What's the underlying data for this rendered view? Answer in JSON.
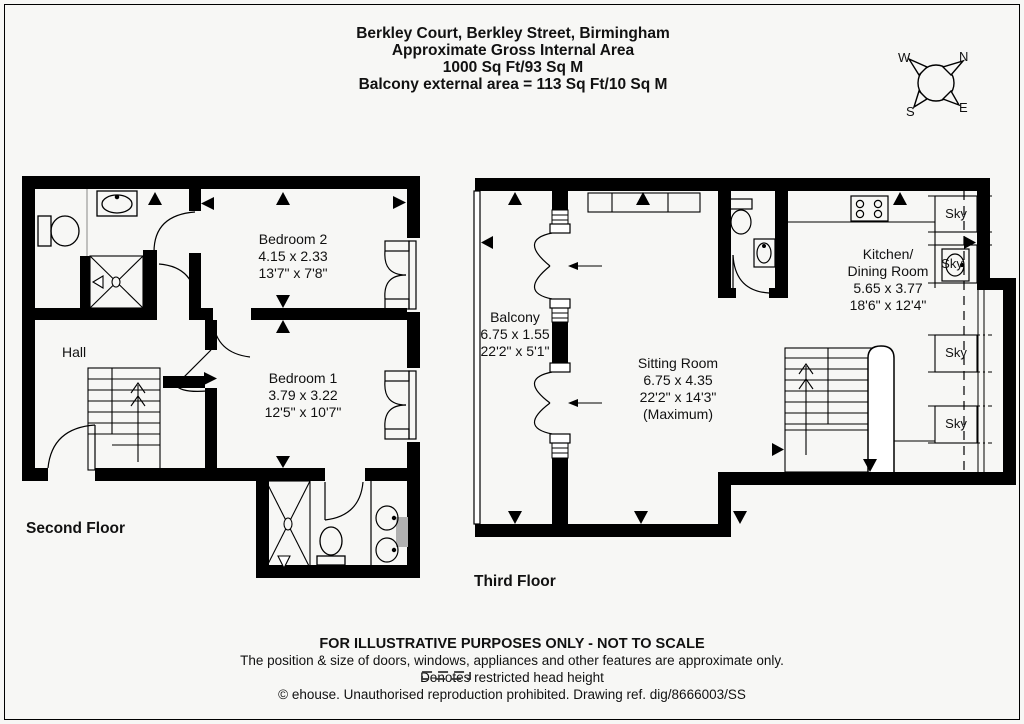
{
  "header": {
    "line1": "Berkley Court, Berkley Street, Birmingham",
    "line2": "Approximate Gross Internal Area",
    "line3": "1000 Sq Ft/93 Sq M",
    "line4": "Balcony external area = 113 Sq Ft/10 Sq M"
  },
  "compass": {
    "n": "N",
    "e": "E",
    "s": "S",
    "w": "W"
  },
  "colors": {
    "walls": "#000000",
    "background": "#f7f7f5",
    "gray_fixture": "#b0b0b0"
  },
  "floors": {
    "second": {
      "label": "Second Floor",
      "rooms": {
        "bedroom2": {
          "name": "Bedroom 2",
          "metric": "4.15 x 2.33",
          "imperial": "13'7\" x 7'8\""
        },
        "bedroom1": {
          "name": "Bedroom 1",
          "metric": "3.79 x 3.22",
          "imperial": "12'5\" x 10'7\""
        },
        "hall": {
          "name": "Hall"
        }
      }
    },
    "third": {
      "label": "Third Floor",
      "rooms": {
        "balcony": {
          "name": "Balcony",
          "metric": "6.75 x 1.55",
          "imperial": "22'2\" x 5'1\""
        },
        "sitting": {
          "name": "Sitting Room",
          "metric": "6.75 x 4.35",
          "imperial": "22'2\" x 14'3\"",
          "note": "(Maximum)"
        },
        "kitchen": {
          "name1": "Kitchen/",
          "name2": "Dining Room",
          "metric": "5.65 x 3.77",
          "imperial": "18'6\" x 12'4\""
        }
      },
      "skylights": [
        "Sky",
        "Sky",
        "Sky",
        "Sky"
      ]
    }
  },
  "footer": {
    "line1": "FOR ILLUSTRATIVE PURPOSES ONLY - NOT TO SCALE",
    "line2": "The position & size of doors, windows, appliances and other features are approximate only.",
    "line3": "Denotes restricted head height",
    "line4": "© ehouse. Unauthorised reproduction prohibited. Drawing ref. dig/8666003/SS"
  }
}
